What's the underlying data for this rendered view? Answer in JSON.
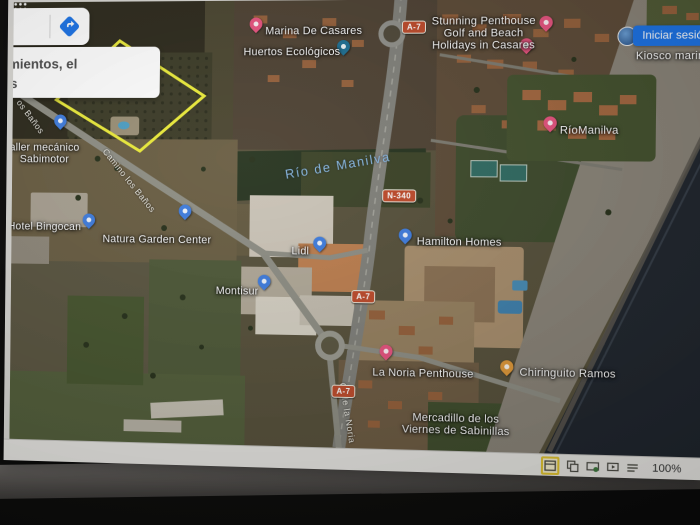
{
  "ui": {
    "signin_label": "Iniciar sesión",
    "zoom_level": "100%",
    "search_suggestion": "azamientos, el\nanos",
    "accent_blue": "#1a73e8",
    "statusbar_icons": [
      "normal-view",
      "slide-sorter",
      "reading-view",
      "slide-show",
      "notes"
    ],
    "tray_icons": [
      "people",
      "chevron-up"
    ],
    "tray_chevron": "^"
  },
  "map": {
    "parcel": {
      "color": "#ecec3a"
    },
    "water_label": "Río de Manilva",
    "pin_colors": {
      "lodging_pink": "#e9537f",
      "poi_blue": "#3e7de0",
      "eco_teal": "#1d6f93",
      "food_orange": "#e29a38"
    },
    "road_badges": [
      {
        "label": "A-7"
      },
      {
        "label": "N-340"
      },
      {
        "label": "A-7"
      },
      {
        "label": "A-7"
      }
    ],
    "road_labels": [
      {
        "text": "os Baños"
      },
      {
        "text": "Camino los Baños"
      },
      {
        "text": "Calle la Noria"
      }
    ],
    "places": [
      {
        "label": "Marina De Casares"
      },
      {
        "label": "Huertos Ecológicos"
      },
      {
        "label": "Stunning Penthouse\nGolf and Beach\nHolidays in Casares"
      },
      {
        "label": "Kiosco marina"
      },
      {
        "label": "RíoManilva"
      },
      {
        "label": "aller mecánico\nSabimotor"
      },
      {
        "label": "Hotel Bingocan"
      },
      {
        "label": "Natura Garden Center"
      },
      {
        "label": "Hamilton Homes"
      },
      {
        "label": "Lidl"
      },
      {
        "label": "Montisur"
      },
      {
        "label": "La Noria Penthouse"
      },
      {
        "label": "Chiringuito Ramos"
      },
      {
        "label": "Mercadillo de los\nViernes de Sabinillas"
      }
    ]
  }
}
